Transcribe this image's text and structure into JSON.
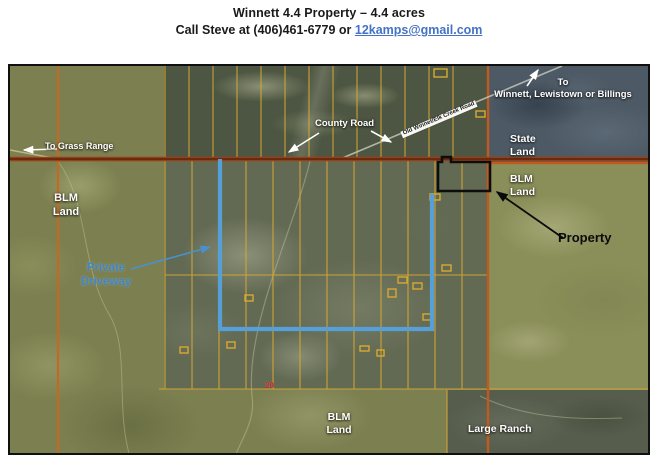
{
  "header": {
    "title": "Winnett 4.4 Property – 4.4 acres",
    "contact_prefix": "Call Steve at (406)461-6779 or ",
    "contact_email": "12kamps@gmail.com"
  },
  "map": {
    "labels": {
      "to_grass_range": "To Grass Range",
      "blm_left_line1": "BLM",
      "blm_left_line2": "Land",
      "county_road": "County Road",
      "creek_road": "Old Winnet/Elk Creek Road",
      "to_winnett_line1": "To",
      "to_winnett_line2": "Winnett, Lewistown or Billings",
      "state_land_line1": "State",
      "state_land_line2": "Land",
      "blm_right_line1": "BLM",
      "blm_right_line2": "Land",
      "property": "Property",
      "private_driveway_line1": "Private",
      "private_driveway_line2": "Driveway",
      "route_marker": "20",
      "blm_bottom_line1": "BLM",
      "blm_bottom_line2": "Land",
      "large_ranch": "Large Ranch"
    },
    "colors": {
      "property_outline": "#0d0d0d",
      "driveway_blue": "#55a0d8",
      "driveway_label_blue": "#3e86c8",
      "parcel_line_yellow": "#d9a930",
      "county_road_red": "#8a3a16",
      "secondary_road_orange": "#c2641f",
      "route_marker_red": "#cf2128",
      "state_land_overlay": "#4d5a66",
      "email_link_blue": "#4472c4"
    }
  }
}
